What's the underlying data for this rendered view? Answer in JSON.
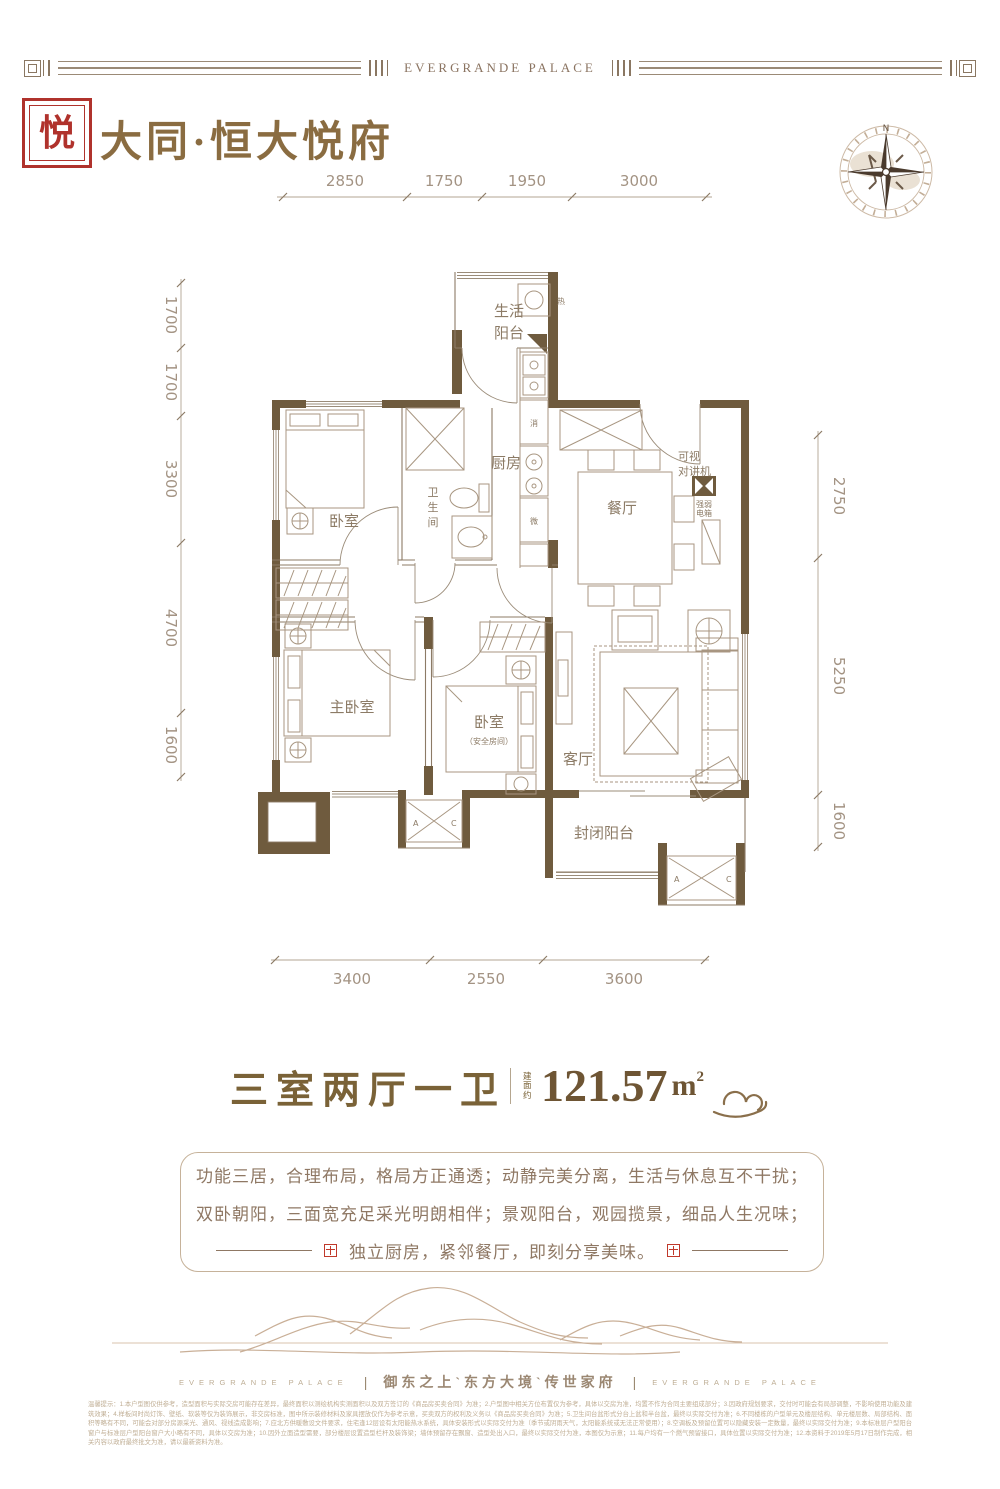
{
  "header": {
    "band_title": "EVERGRANDE PALACE",
    "logo_char": "悦",
    "project_title": "大同·恒大悦府",
    "compass_north": "N"
  },
  "dims": {
    "top": [
      "2850",
      "1750",
      "1950",
      "3000"
    ],
    "left": [
      "1700",
      "1700",
      "3300",
      "4700",
      "1600"
    ],
    "right": [
      "2750",
      "5250",
      "1600"
    ],
    "bottom": [
      "3400",
      "2550",
      "3600"
    ]
  },
  "rooms": {
    "life_balcony_1": "生活",
    "life_balcony_2": "阳台",
    "kitchen": "厨房",
    "dining": "餐厅",
    "bath": [
      "卫",
      "生",
      "间"
    ],
    "bedroom1": "卧室",
    "master": "主卧室",
    "bedroom2": "卧室",
    "bedroom2_note": "（安全房间）",
    "living": "客厅",
    "closed_balcony": "封闭阳台"
  },
  "ann": {
    "heater": "热",
    "sterilizer": "消",
    "microwave": "微",
    "intercom_1": "可视",
    "intercom_2": "对讲机",
    "ebox_1": "强弱",
    "ebox_2": "电箱",
    "ac_a": "A",
    "ac_c": "C"
  },
  "summary": {
    "layout_name": "三室两厅一卫",
    "area_label": "建面约",
    "area_value": "121.57",
    "area_unit": "m",
    "area_sup": "2"
  },
  "description": {
    "line1": "功能三居，合理布局，格局方正通透；动静完美分离，生活与休息互不干扰；",
    "line2": "双卧朝阳，三面宽充足采光明朗相伴；景观阳台，观园揽景，细品人生况味；",
    "line3": "独立厨房，紧邻餐厅，即刻分享美味。"
  },
  "footer": {
    "brand_en": "EVERGRANDE PALACE",
    "divider": "|",
    "tagline": "御东之上`东方大境`传世家府",
    "disclaimer": "温馨提示：1.本户型图仅供参考，造型面积与实际交房可能存在差异，最终面积以测绘机构实测面积以及双方签订的《商品房买卖合同》为准；2.户型图中相关方位布置仅为参考，具体以交房为准，均置不作为合同主要组成部分；3.因政府规划要求，交付时可能会有局部调整，不影响使用功能及建筑效果；4.样板间时尚灯饰、壁纸、软装等仅为装饰展示，非交房标准，图中所示装修材料及家具摆放仅作为参考示意，买卖双方的权利及义务以《商品房买卖合同》为准；5.卫生间台盆形式分台上盆和半台盆，最终以实际交付为准；6.不同楼栋的户型单元及楼层结构、单元楼层数、局部结构、面积等略有不同，可能会对部分房源采光、通风、视线造成影响；7.应北方供暖敷设文件要求，住宅逢12层设有太阳能热水系统，具体安装形式以实际交付为准（季节或阴雨天气，太阳能系统或无法正常使用）；8.空调板及预留位置可以隐藏安装一定数量，最终以实际交付为准；9.本标准层户型阳台窗户与标准层户型阳台窗户大小略有不同，具体以交房为准；10.因外立面造型需要，部分楼层设置造型栏杆及装饰梁；墙体预留存在飘窗、造型处出入口，最终以实际交付为准，本图仅为示意；11.每户均有一个燃气预留接口，具体位置以实际交付为准；12.本资料于2019年5月17日制作完成，相关内容以政府最终批文为准，请以最新资料为准。"
  }
}
